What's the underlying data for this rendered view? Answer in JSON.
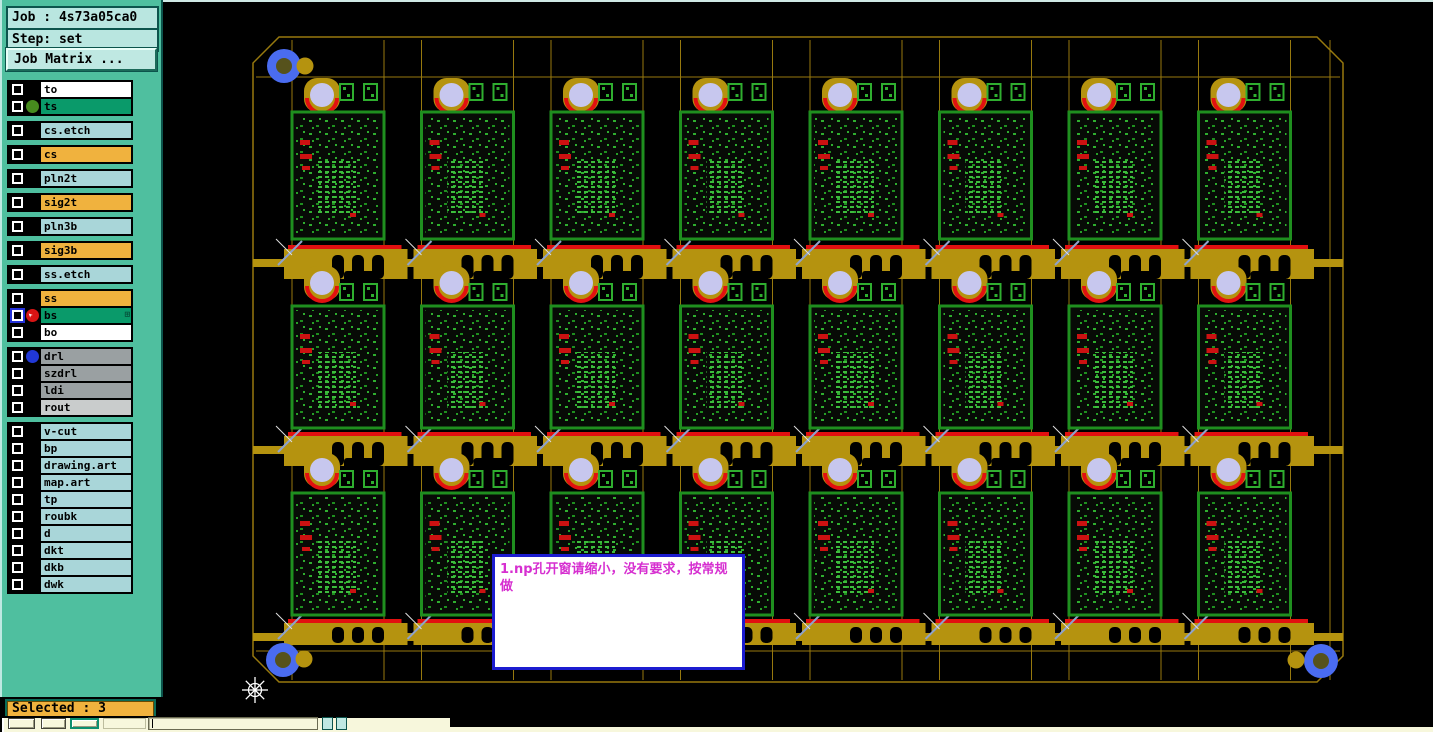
{
  "sidebar": {
    "job_label": "Job : 4s73a05ca0",
    "step_label": "Step: set",
    "matrix_button": "Job Matrix ...",
    "selected_label": "Selected : 3",
    "layer_groups": [
      [
        {
          "name": "to",
          "bg": "#ffffff"
        },
        {
          "name": "ts",
          "bg": "#0a9a6a",
          "icon": "green-dot-icon"
        }
      ],
      [
        {
          "name": "cs.etch",
          "bg": "#a9d6d9"
        }
      ],
      [
        {
          "name": "cs",
          "bg": "#f0b23e"
        }
      ],
      [
        {
          "name": "pln2t",
          "bg": "#a9d6d9"
        }
      ],
      [
        {
          "name": "sig2t",
          "bg": "#f0b23e"
        }
      ],
      [
        {
          "name": "pln3b",
          "bg": "#a9d6d9"
        }
      ],
      [
        {
          "name": "sig3b",
          "bg": "#f0b23e"
        }
      ],
      [
        {
          "name": "ss.etch",
          "bg": "#a9d6d9"
        }
      ],
      [
        {
          "name": "ss",
          "bg": "#f0b23e"
        },
        {
          "name": "bs",
          "bg": "#0a9a6a",
          "icon": "pointer-arrow-icon",
          "checkbox": "blue",
          "badge": "grid-icon"
        },
        {
          "name": "bo",
          "bg": "#ffffff"
        }
      ],
      [
        {
          "name": "drl",
          "bg": "#9aa0a2",
          "icon": "blue-dot-icon"
        },
        {
          "name": "szdrl",
          "bg": "#9aa0a2"
        },
        {
          "name": "ldi",
          "bg": "#9aa0a2"
        },
        {
          "name": "rout",
          "bg": "#c9cccc"
        }
      ],
      [
        {
          "name": "v-cut",
          "bg": "#a9d6d9"
        },
        {
          "name": "bp",
          "bg": "#a9d6d9"
        },
        {
          "name": "drawing.art",
          "bg": "#a9d6d9"
        },
        {
          "name": "map.art",
          "bg": "#a9d6d9"
        },
        {
          "name": "tp",
          "bg": "#a9d6d9"
        },
        {
          "name": "roubk",
          "bg": "#a9d6d9"
        },
        {
          "name": "d",
          "bg": "#a9d6d9"
        },
        {
          "name": "dkt",
          "bg": "#a9d6d9"
        },
        {
          "name": "dkb",
          "bg": "#a9d6d9"
        },
        {
          "name": "dwk",
          "bg": "#a9d6d9"
        }
      ]
    ]
  },
  "note": {
    "text": "1.np孔开窗请缩小，没有要求，按常规做",
    "text_color": "#d62fd0",
    "border_color": "#1c1cd0"
  },
  "panel": {
    "rows": 3,
    "cols": 8,
    "colors": {
      "gold": "#b5930f",
      "gold_line": "#97790e",
      "red": "#e21010",
      "lavender": "#c7c7ee",
      "fiducial_blue": "#4a6cf0",
      "fiducial_center": "#56521c",
      "board_border": "#1f8f1f",
      "component_green": "#2fae2f",
      "component_bright": "#3dbd3d",
      "mark_red": "#cc1111",
      "xmark_blue": "#8fa3cc",
      "crosshair_white": "#ffffff"
    }
  },
  "toolbar": {
    "input_value": ""
  }
}
